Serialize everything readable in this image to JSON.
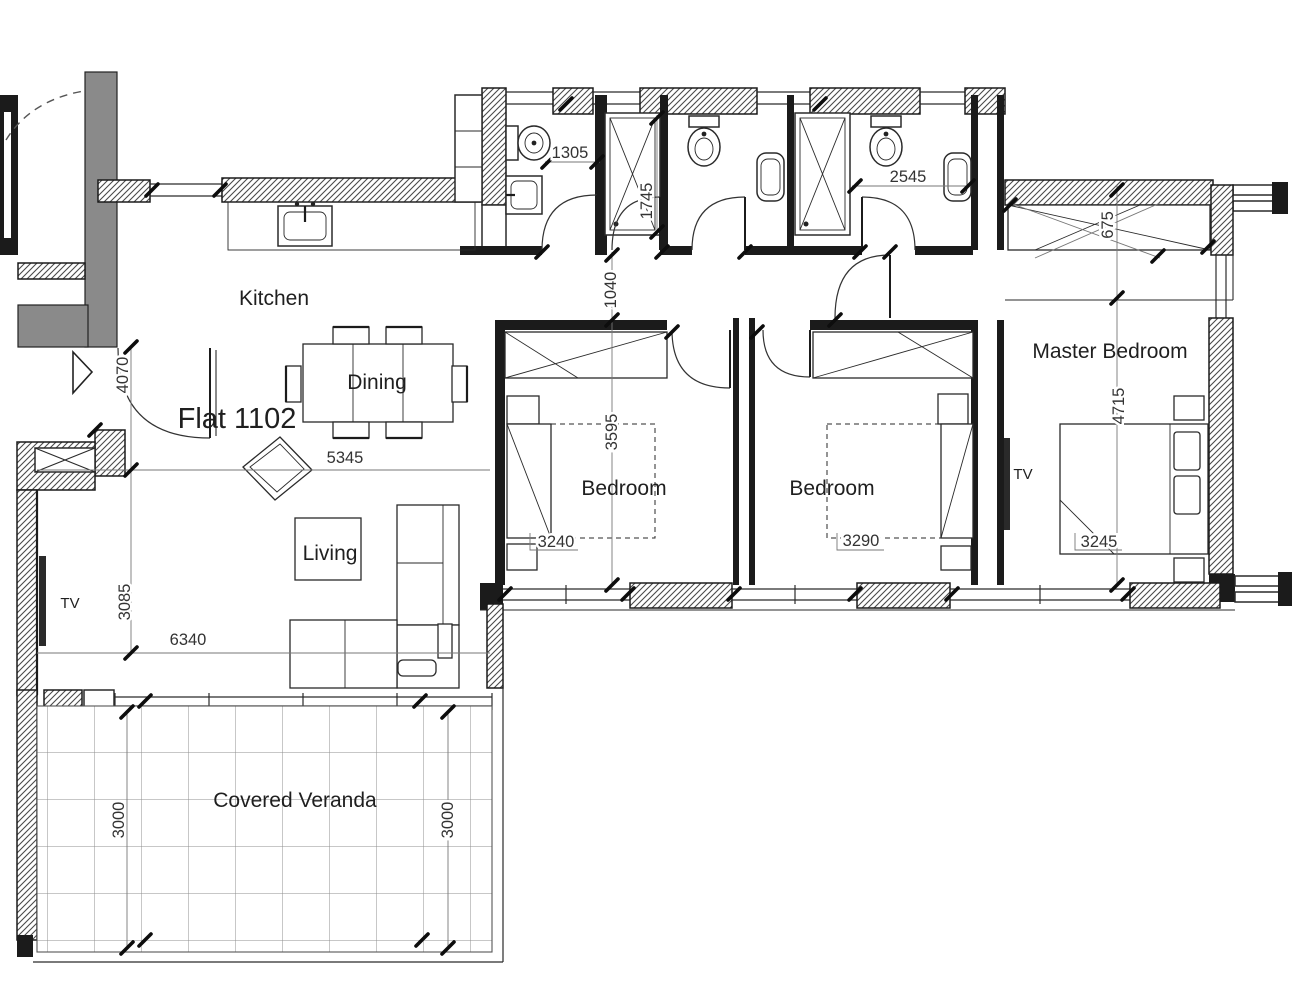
{
  "plan": {
    "title": "Flat 1102",
    "rooms": {
      "kitchen": "Kitchen",
      "dining": "Dining",
      "living": "Living",
      "bedroom1": "Bedroom",
      "bedroom2": "Bedroom",
      "master": "Master Bedroom",
      "veranda": "Covered Veranda"
    },
    "labels": {
      "tv_living": "TV",
      "tv_master": "TV"
    },
    "dims": {
      "wc_width": "1305",
      "shower_depth": "1745",
      "bath2_width": "2545",
      "master_offset": "675",
      "hall_width": "1040",
      "entry_span": "4070",
      "bedroom_depth": "3595",
      "master_depth": "4715",
      "dining_span": "5345",
      "bedroom1_width": "3240",
      "bedroom2_width": "3290",
      "master_width": "3245",
      "living_depth": "3085",
      "living_width": "6340",
      "veranda_depth_left": "3000",
      "veranda_depth_right": "3000"
    },
    "colors": {
      "wall": "#1b1b1b",
      "core_gray": "#8a8a8a",
      "paper": "#ffffff"
    }
  }
}
